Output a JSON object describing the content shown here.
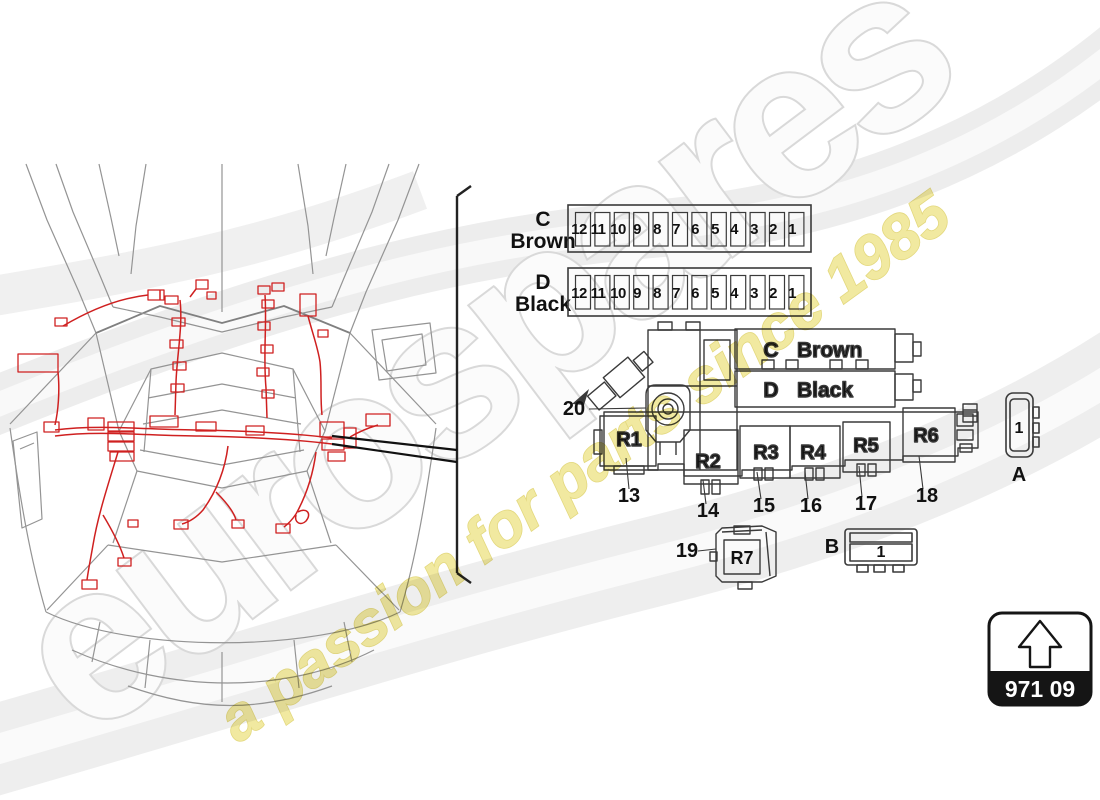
{
  "watermark": {
    "brand": "eurospares",
    "tagline": "a passion for parts since 1985"
  },
  "partcode": {
    "label": "971 09"
  },
  "fuse_rows": [
    {
      "id": "C",
      "color": "Brown",
      "slots": [
        "12",
        "11",
        "10",
        "9",
        "8",
        "7",
        "6",
        "5",
        "4",
        "3",
        "2",
        "1"
      ]
    },
    {
      "id": "D",
      "color": "Black",
      "slots": [
        "12",
        "11",
        "10",
        "9",
        "8",
        "7",
        "6",
        "5",
        "4",
        "3",
        "2",
        "1"
      ]
    }
  ],
  "carrier": {
    "bar_c": {
      "id": "C",
      "color": "Brown"
    },
    "bar_d": {
      "id": "D",
      "color": "Black"
    },
    "relays": {
      "r1": "R1",
      "r2": "R2",
      "r3": "R3",
      "r4": "R4",
      "r5": "R5",
      "r6": "R6",
      "r7": "R7"
    },
    "callouts": {
      "c13": "13",
      "c14": "14",
      "c15": "15",
      "c16": "16",
      "c17": "17",
      "c18": "18",
      "c19": "19",
      "c20": "20"
    },
    "connector_a": {
      "label": "A",
      "slot": "1"
    },
    "connector_b": {
      "label": "B",
      "slot": "1"
    }
  },
  "colors": {
    "harness_red": "#cf2020",
    "line_dark": "#3a3a3a",
    "car_gray": "#949494",
    "watermark_yellow": "#f1e9a0",
    "watermark_gray": "#d9d9d9",
    "part_box_black": "#151515"
  }
}
